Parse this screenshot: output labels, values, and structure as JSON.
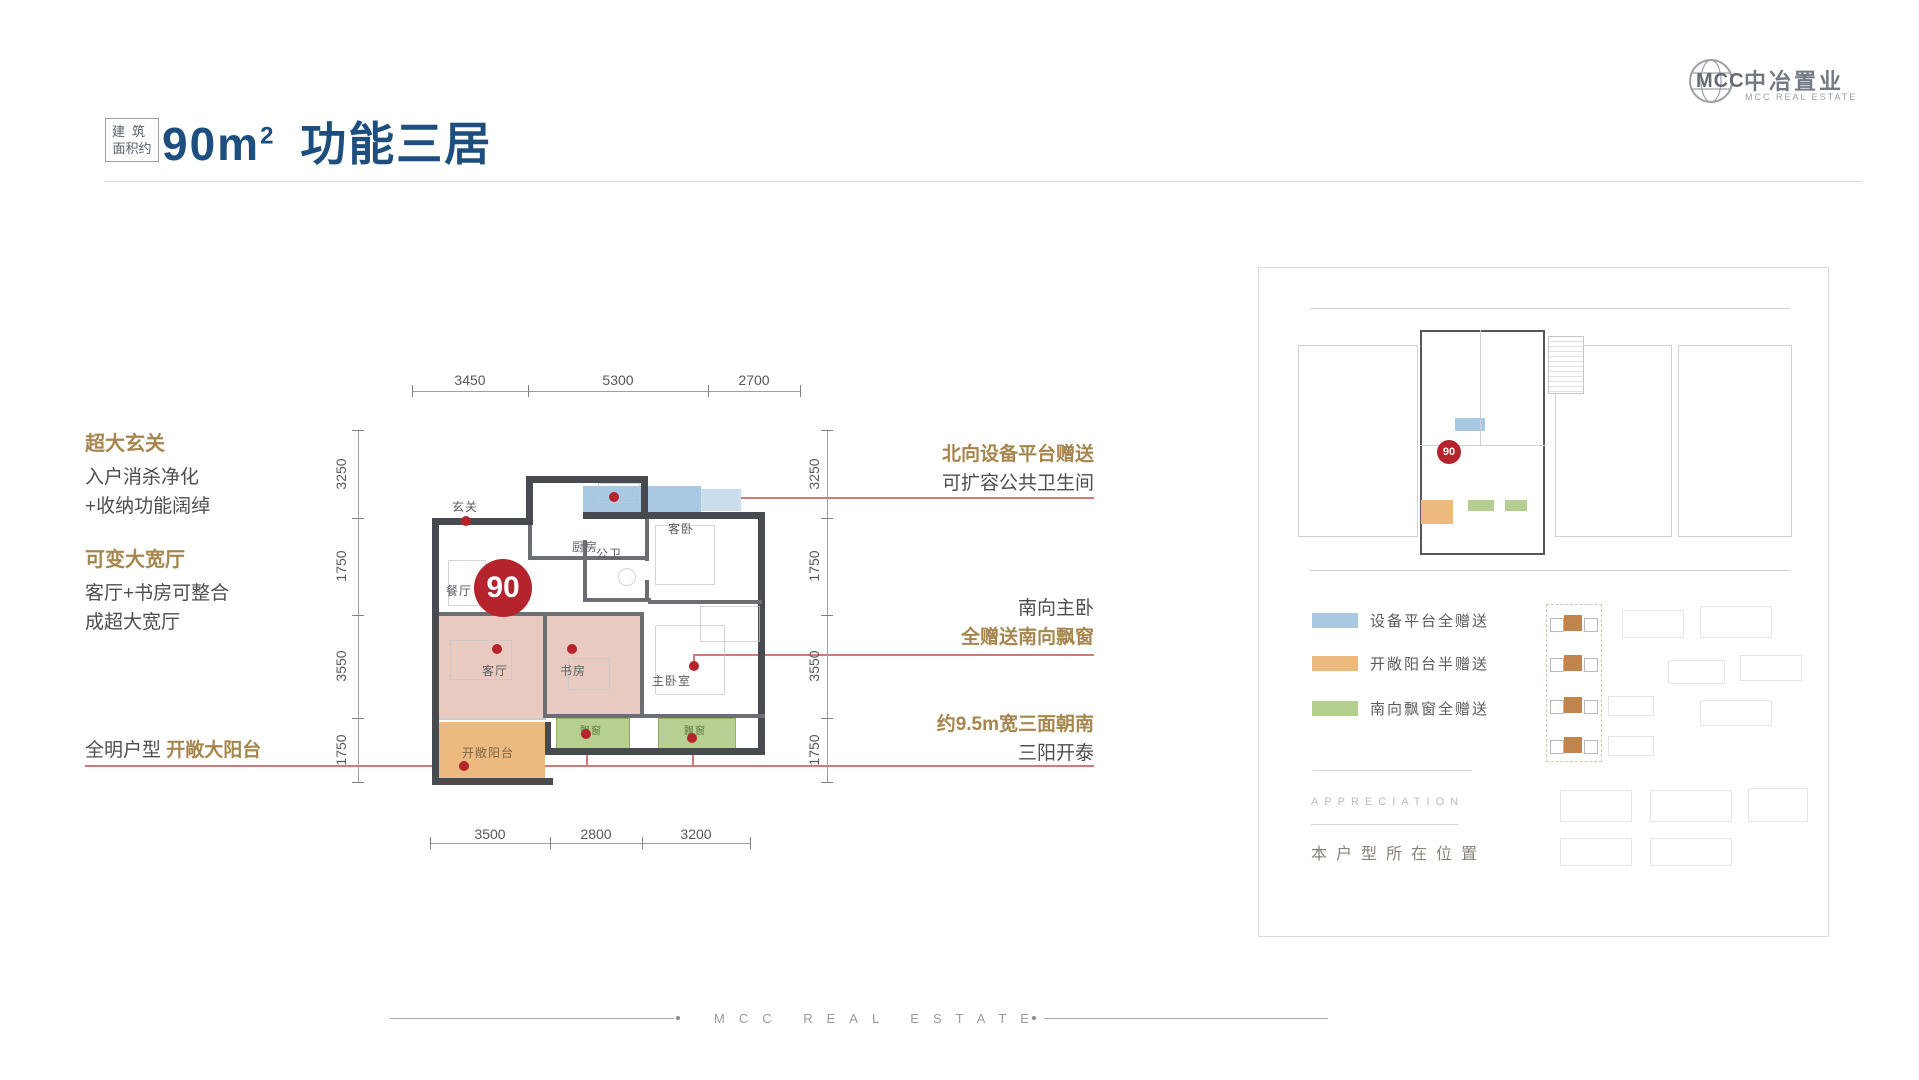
{
  "logo": {
    "mcc": "MCC",
    "name_cn": "中冶置业",
    "name_en": "MCC REAL ESTATE"
  },
  "title": {
    "badge_line1": "建筑",
    "badge_line2": "面积约",
    "area": "90m",
    "area_sup": "2",
    "suffix": "功能三居"
  },
  "floor_plan": {
    "unit_number": "90",
    "rooms": {
      "entry": "玄关",
      "kitchen": "厨房",
      "bath": "公卫",
      "guest_bedroom": "客卧",
      "dining": "餐厅",
      "living": "客厅",
      "study": "书房",
      "master_bedroom": "主卧室",
      "balcony": "开敞阳台",
      "bay_window": "飘窗"
    },
    "dims": {
      "top": [
        "3450",
        "5300",
        "2700"
      ],
      "bottom": [
        "3500",
        "2800",
        "3200"
      ],
      "left": [
        "3250",
        "1750",
        "3550",
        "1750"
      ],
      "right": [
        "3250",
        "1750",
        "3550",
        "1750"
      ]
    }
  },
  "annotations_left": [
    {
      "heading": "超大玄关",
      "line1": "入户消杀净化",
      "line2": "+收纳功能阔绰"
    },
    {
      "heading": "可变大宽厅",
      "line1": "客厅+书房可整合",
      "line2": "成超大宽厅"
    },
    {
      "normal": "全明户型 ",
      "highlight": "开敞大阳台"
    }
  ],
  "annotations_right": [
    {
      "gold": "北向设备平台赠送",
      "dark": "可扩容公共卫生间"
    },
    {
      "dark": "南向主卧",
      "gold": "全赠送南向飘窗"
    },
    {
      "gold": "约9.5m宽三面朝南",
      "dark": "三阳开泰"
    }
  ],
  "panel": {
    "unit_badge": "90",
    "legend": [
      {
        "color": "#a9c9e2",
        "label": "设备平台全赠送"
      },
      {
        "color": "#ecb97e",
        "label": "开敞阳台半赠送"
      },
      {
        "color": "#b5cf8e",
        "label": "南向飘窗全赠送"
      }
    ],
    "watermark": "APPRECIATION",
    "location_label": "本户型所在位置"
  },
  "footer": {
    "text": "MCC REAL ESTATE"
  },
  "colors": {
    "title_navy": "#1d4e7e",
    "annotation_gold": "#a6864e",
    "accent_red": "#b5242c",
    "leader_red": "#d07a7a",
    "platform_blue": "#a9c9e2",
    "balcony_orange": "#ecb97e",
    "bay_green": "#b5cf8e",
    "room_pink": "#e9cac1",
    "wall_dark": "#474b4f"
  }
}
